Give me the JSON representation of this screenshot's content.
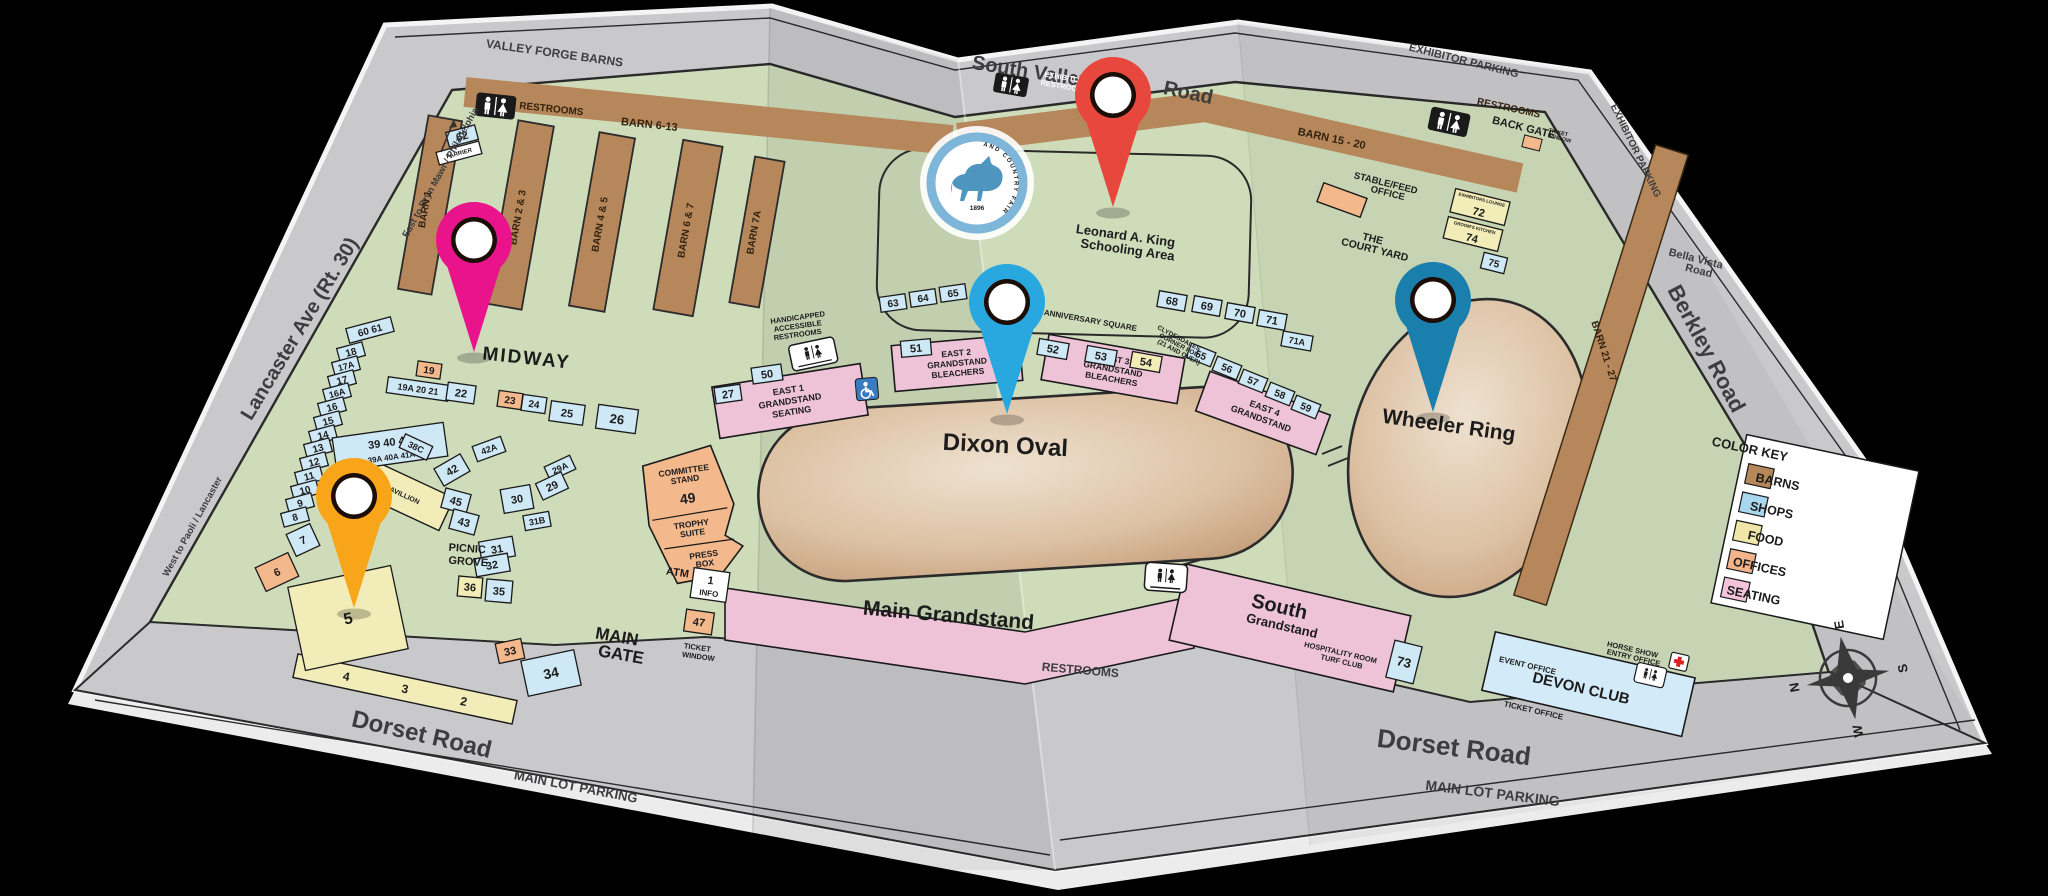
{
  "palette": {
    "paper": "#c9c9cb",
    "green": "#cfdcba",
    "barn": "#b5875a",
    "shop": "#cfe8f6",
    "food": "#f1ecb8",
    "office": "#f3b88c",
    "seating": "#eec3d8"
  },
  "roads": {
    "valley_forge_barns": "VALLEY FORGE BARNS",
    "east_to": "East to Bryn Mawr / Philadelphia",
    "south_valley": "South Valley",
    "road2": "Road",
    "exhibitor_top": "EXHIBITOR PARKING",
    "exhibitor_right": "EXHIBITOR PARKING",
    "bella1": "Bella Vista",
    "bella2": "Road",
    "berkley": "Berkley Road",
    "lancaster": "Lancaster Ave (Rt. 30)",
    "west_to": "West to Paoli / Lancaster",
    "dorset_left": "Dorset Road",
    "dorset_right": "Dorset Road",
    "main_lot_left": "MAIN LOT PARKING",
    "main_lot_right": "MAIN LOT PARKING",
    "restrooms_bottom": "RESTROOMS"
  },
  "barns": {
    "b1": "BARN 1",
    "b23": "BARN 2 & 3",
    "b45": "BARN 4 & 5",
    "b67": "BARN 6 & 7",
    "b7a": "BARN 7A",
    "strip_left": "BARN 6-13",
    "strip_right": "BARN 15 - 20",
    "strip_east": "BARN 21 - 27",
    "farrier": "FARRIER"
  },
  "areas": {
    "midway": "MIDWAY",
    "dixon": "Dixon Oval",
    "wheeler": "Wheeler Ring",
    "school1": "Leonard A. King",
    "school2": "Schooling Area",
    "anniversary": "ANNIVERSARY SQUARE",
    "court1": "THE",
    "court2": "COURT YARD",
    "stable1": "STABLE/FEED",
    "stable2": "OFFICE",
    "back_gate": "BACK GATE",
    "picnic1": "PICNIC",
    "picnic2": "GROVE",
    "pavilion": "PAVILLION",
    "main_gs": "Main Grandstand",
    "south1": "South",
    "south2": "Grandstand",
    "hosp1": "HOSPITALITY ROOM",
    "hosp2": "TURF CLUB",
    "gate1": "MAIN",
    "gate2": "GATE",
    "atm": "ATM"
  },
  "club": {
    "devon": "DEVON CLUB",
    "event": "EVENT OFFICE",
    "entry1": "HORSE SHOW",
    "entry2": "ENTRY OFFICE",
    "ticket": "TICKET OFFICE"
  },
  "committee": {
    "l1": "COMMITTEE",
    "l2": "STAND",
    "num": "49",
    "t1": "TROPHY",
    "t2": "SUITE",
    "p1": "PRESS",
    "p2": "BOX"
  },
  "stands": [
    {
      "n": "EAST 1",
      "t": "GRANDSTAND",
      "b": "SEATING"
    },
    {
      "n": "EAST 2",
      "t": "GRANDSTAND",
      "b": "BLEACHERS"
    },
    {
      "n": "EAST 3",
      "t": "GRANDSTAND",
      "b": "BLEACHERS"
    },
    {
      "n": "EAST 4",
      "t": "GRANDSTAND",
      "b": ""
    }
  ],
  "misc": {
    "restrooms_left": "RESTROOMS",
    "restrooms_right": "RESTROOMS",
    "exhibitor1": "EXHIBITOR",
    "exhibitor2": "RESTROOMS",
    "tw_small1": "TICKET",
    "tw_small2": "WINDOW",
    "tw1": "TICKET",
    "tw2": "WINDOW",
    "hand1": "HANDICAPPED",
    "hand2": "ACCESSIBLE",
    "hand3": "RESTROOMS",
    "clyde1": "CLYDESDALES",
    "clyde2": "CORNER FOR",
    "clyde3": "(21 AND OVER)"
  },
  "strip432": {
    "a": "4",
    "b": "3",
    "c": "2"
  },
  "key": {
    "title": "COLOR KEY",
    "items": [
      {
        "label": "BARNS",
        "color": "#b5875a"
      },
      {
        "label": "SHOPS",
        "color": "#a9d7ee"
      },
      {
        "label": "FOOD",
        "color": "#efe6a8"
      },
      {
        "label": "OFFICES",
        "color": "#f2b488"
      },
      {
        "label": "SEATING",
        "color": "#f3c3dc"
      }
    ]
  },
  "compass": {
    "n": "N",
    "e": "E",
    "s": "S",
    "w": "W"
  },
  "logo": {
    "ring": "DEVON HORSE SHOW AND COUNTRY FAIR",
    "year": "1896"
  },
  "boxes": [
    {
      "l": "62",
      "x": 462,
      "y": 136,
      "w": 30,
      "h": 15,
      "r": -15
    },
    {
      "l": "FARRIER",
      "x": 459,
      "y": 153,
      "w": 44,
      "h": 13,
      "r": -15,
      "cat": "white",
      "fs": 6
    },
    {
      "l": "60 61",
      "x": 370,
      "y": 330,
      "w": 46,
      "h": 15,
      "r": -15,
      "fs": 10
    },
    {
      "l": "18",
      "x": 351,
      "y": 352,
      "w": 26,
      "h": 14,
      "r": -15,
      "fs": 10
    },
    {
      "l": "17A",
      "x": 346,
      "y": 366,
      "w": 26,
      "h": 14,
      "r": -15,
      "fs": 9
    },
    {
      "l": "17",
      "x": 342,
      "y": 380,
      "w": 26,
      "h": 14,
      "r": -15,
      "fs": 10
    },
    {
      "l": "16A",
      "x": 337,
      "y": 393,
      "w": 26,
      "h": 14,
      "r": -15,
      "fs": 9
    },
    {
      "l": "16",
      "x": 332,
      "y": 407,
      "w": 26,
      "h": 14,
      "r": -15,
      "fs": 10
    },
    {
      "l": "15",
      "x": 328,
      "y": 421,
      "w": 26,
      "h": 14,
      "r": -15,
      "fs": 10
    },
    {
      "l": "14",
      "x": 323,
      "y": 435,
      "w": 26,
      "h": 14,
      "r": -15,
      "fs": 10
    },
    {
      "l": "13",
      "x": 318,
      "y": 448,
      "w": 26,
      "h": 14,
      "r": -15,
      "fs": 10
    },
    {
      "l": "12",
      "x": 314,
      "y": 462,
      "w": 26,
      "h": 14,
      "r": -15,
      "fs": 10
    },
    {
      "l": "11",
      "x": 309,
      "y": 476,
      "w": 26,
      "h": 14,
      "r": -15,
      "fs": 10
    },
    {
      "l": "10",
      "x": 305,
      "y": 490,
      "w": 26,
      "h": 14,
      "r": -15,
      "fs": 10
    },
    {
      "l": "9",
      "x": 300,
      "y": 503,
      "w": 26,
      "h": 14,
      "r": -15,
      "fs": 10
    },
    {
      "l": "8",
      "x": 295,
      "y": 517,
      "w": 26,
      "h": 14,
      "r": -15,
      "fs": 10
    },
    {
      "l": "7",
      "x": 303,
      "y": 540,
      "w": 26,
      "h": 24,
      "r": -25
    },
    {
      "l": "6",
      "x": 277,
      "y": 572,
      "w": 36,
      "h": 26,
      "r": -25,
      "cat": "office"
    },
    {
      "l": "5",
      "x": 348,
      "y": 618,
      "w": 105,
      "h": 85,
      "r": -12,
      "cat": "food",
      "fs": 16
    },
    {
      "l": "19",
      "x": 429,
      "y": 370,
      "w": 24,
      "h": 15,
      "r": 8,
      "cat": "office",
      "fs": 10
    },
    {
      "l": "19A 20 21",
      "x": 418,
      "y": 389,
      "w": 62,
      "h": 16,
      "r": 8,
      "fs": 9
    },
    {
      "l": "22",
      "x": 461,
      "y": 393,
      "w": 28,
      "h": 18,
      "r": 8
    },
    {
      "l": "23",
      "x": 510,
      "y": 400,
      "w": 24,
      "h": 16,
      "r": 8,
      "cat": "office",
      "fs": 10
    },
    {
      "l": "24",
      "x": 534,
      "y": 404,
      "w": 24,
      "h": 16,
      "r": 8,
      "fs": 10
    },
    {
      "l": "25",
      "x": 567,
      "y": 413,
      "w": 34,
      "h": 20,
      "r": 8
    },
    {
      "l": "26",
      "x": 617,
      "y": 419,
      "w": 40,
      "h": 24,
      "r": 8,
      "fs": 13
    },
    {
      "l": "39  40  41",
      "l2": "39A 40A 41A",
      "x": 390,
      "y": 447,
      "w": 112,
      "h": 34,
      "r": -8,
      "fs": 11
    },
    {
      "l": "42A",
      "x": 489,
      "y": 449,
      "w": 30,
      "h": 16,
      "r": -20,
      "fs": 9
    },
    {
      "l": "42",
      "x": 452,
      "y": 470,
      "w": 30,
      "h": 20,
      "r": -30
    },
    {
      "l": "29A",
      "x": 560,
      "y": 468,
      "w": 28,
      "h": 15,
      "r": -25,
      "fs": 9
    },
    {
      "l": "29",
      "x": 552,
      "y": 486,
      "w": 28,
      "h": 18,
      "r": -25
    },
    {
      "l": "45",
      "x": 456,
      "y": 501,
      "w": 26,
      "h": 20,
      "r": 15
    },
    {
      "l": "43",
      "x": 464,
      "y": 522,
      "w": 26,
      "h": 20,
      "r": 15
    },
    {
      "l": "30",
      "x": 517,
      "y": 499,
      "w": 30,
      "h": 24,
      "r": -10
    },
    {
      "l": "31B",
      "x": 537,
      "y": 521,
      "w": 26,
      "h": 15,
      "r": -10,
      "fs": 9
    },
    {
      "l": "31",
      "x": 497,
      "y": 549,
      "w": 34,
      "h": 20,
      "r": -10
    },
    {
      "l": "32",
      "x": 492,
      "y": 565,
      "w": 34,
      "h": 18,
      "r": -10
    },
    {
      "l": "36",
      "x": 470,
      "y": 587,
      "w": 24,
      "h": 20,
      "r": 5,
      "cat": "food"
    },
    {
      "l": "35",
      "x": 499,
      "y": 591,
      "w": 26,
      "h": 22,
      "r": 5
    },
    {
      "l": "33",
      "x": 510,
      "y": 651,
      "w": 26,
      "h": 20,
      "r": -12,
      "cat": "office"
    },
    {
      "l": "34",
      "x": 551,
      "y": 673,
      "w": 54,
      "h": 36,
      "r": -12,
      "fs": 14
    },
    {
      "l": "38C",
      "x": 416,
      "y": 447,
      "w": 30,
      "h": 15,
      "r": 25,
      "fs": 9
    },
    {
      "l": "27",
      "x": 728,
      "y": 394,
      "w": 26,
      "h": 16,
      "r": -8
    },
    {
      "l": "50",
      "x": 767,
      "y": 374,
      "w": 30,
      "h": 16,
      "r": -8
    },
    {
      "l": "51",
      "x": 916,
      "y": 348,
      "w": 30,
      "h": 16,
      "r": -5
    },
    {
      "l": "52",
      "x": 1053,
      "y": 349,
      "w": 30,
      "h": 16,
      "r": 10
    },
    {
      "l": "53",
      "x": 1101,
      "y": 356,
      "w": 30,
      "h": 16,
      "r": 10
    },
    {
      "l": "54",
      "x": 1146,
      "y": 362,
      "w": 30,
      "h": 16,
      "r": 10,
      "cat": "food"
    },
    {
      "l": "55",
      "x": 1201,
      "y": 355,
      "w": 26,
      "h": 15,
      "r": 22,
      "fs": 10
    },
    {
      "l": "56",
      "x": 1227,
      "y": 368,
      "w": 26,
      "h": 15,
      "r": 22,
      "fs": 10
    },
    {
      "l": "57",
      "x": 1253,
      "y": 381,
      "w": 26,
      "h": 15,
      "r": 22,
      "fs": 10
    },
    {
      "l": "58",
      "x": 1280,
      "y": 394,
      "w": 26,
      "h": 15,
      "r": 22,
      "fs": 10
    },
    {
      "l": "59",
      "x": 1306,
      "y": 407,
      "w": 26,
      "h": 15,
      "r": 22,
      "fs": 10
    },
    {
      "l": "63",
      "x": 893,
      "y": 303,
      "w": 26,
      "h": 15,
      "r": -8,
      "fs": 10
    },
    {
      "l": "64",
      "x": 923,
      "y": 298,
      "w": 26,
      "h": 15,
      "r": -8,
      "fs": 10
    },
    {
      "l": "65",
      "x": 953,
      "y": 293,
      "w": 26,
      "h": 15,
      "r": -8,
      "fs": 10
    },
    {
      "l": "68",
      "x": 1172,
      "y": 301,
      "w": 28,
      "h": 16,
      "r": 10
    },
    {
      "l": "69",
      "x": 1207,
      "y": 306,
      "w": 28,
      "h": 16,
      "r": 10
    },
    {
      "l": "70",
      "x": 1240,
      "y": 313,
      "w": 28,
      "h": 16,
      "r": 10
    },
    {
      "l": "71",
      "x": 1272,
      "y": 320,
      "w": 28,
      "h": 16,
      "r": 10
    },
    {
      "l": "71A",
      "x": 1297,
      "y": 341,
      "w": 30,
      "h": 15,
      "r": 10,
      "fs": 9
    },
    {
      "l": "72",
      "hdr": "EXHIBITORS LOUNGE",
      "x": 1480,
      "y": 207,
      "w": 56,
      "h": 24,
      "r": 14,
      "cat": "food"
    },
    {
      "l": "74",
      "hdr": "GROOM'S KITCHEN",
      "x": 1473,
      "y": 234,
      "w": 56,
      "h": 22,
      "r": 14,
      "cat": "food"
    },
    {
      "l": "75",
      "x": 1494,
      "y": 263,
      "w": 24,
      "h": 16,
      "r": 14,
      "fs": 10
    },
    {
      "l": "73",
      "x": 1404,
      "y": 662,
      "w": 28,
      "h": 38,
      "r": 14,
      "fs": 13
    },
    {
      "l": "47",
      "x": 699,
      "y": 622,
      "w": 28,
      "h": 22,
      "r": 8,
      "cat": "office"
    },
    {
      "l": "1",
      "l2": "INFO",
      "x": 710,
      "y": 585,
      "w": 36,
      "h": 30,
      "r": 8,
      "cat": "white",
      "fs": 11
    }
  ],
  "pins": [
    {
      "name": "pin-magenta",
      "color": "#e9148c",
      "x": 474,
      "y": 240
    },
    {
      "name": "pin-red",
      "color": "#e8473d",
      "x": 1113,
      "y": 95
    },
    {
      "name": "pin-cyan",
      "color": "#29a8e0",
      "x": 1007,
      "y": 302
    },
    {
      "name": "pin-teal",
      "color": "#1b7fae",
      "x": 1433,
      "y": 300
    },
    {
      "name": "pin-orange",
      "color": "#f9a51a",
      "x": 354,
      "y": 496
    }
  ]
}
